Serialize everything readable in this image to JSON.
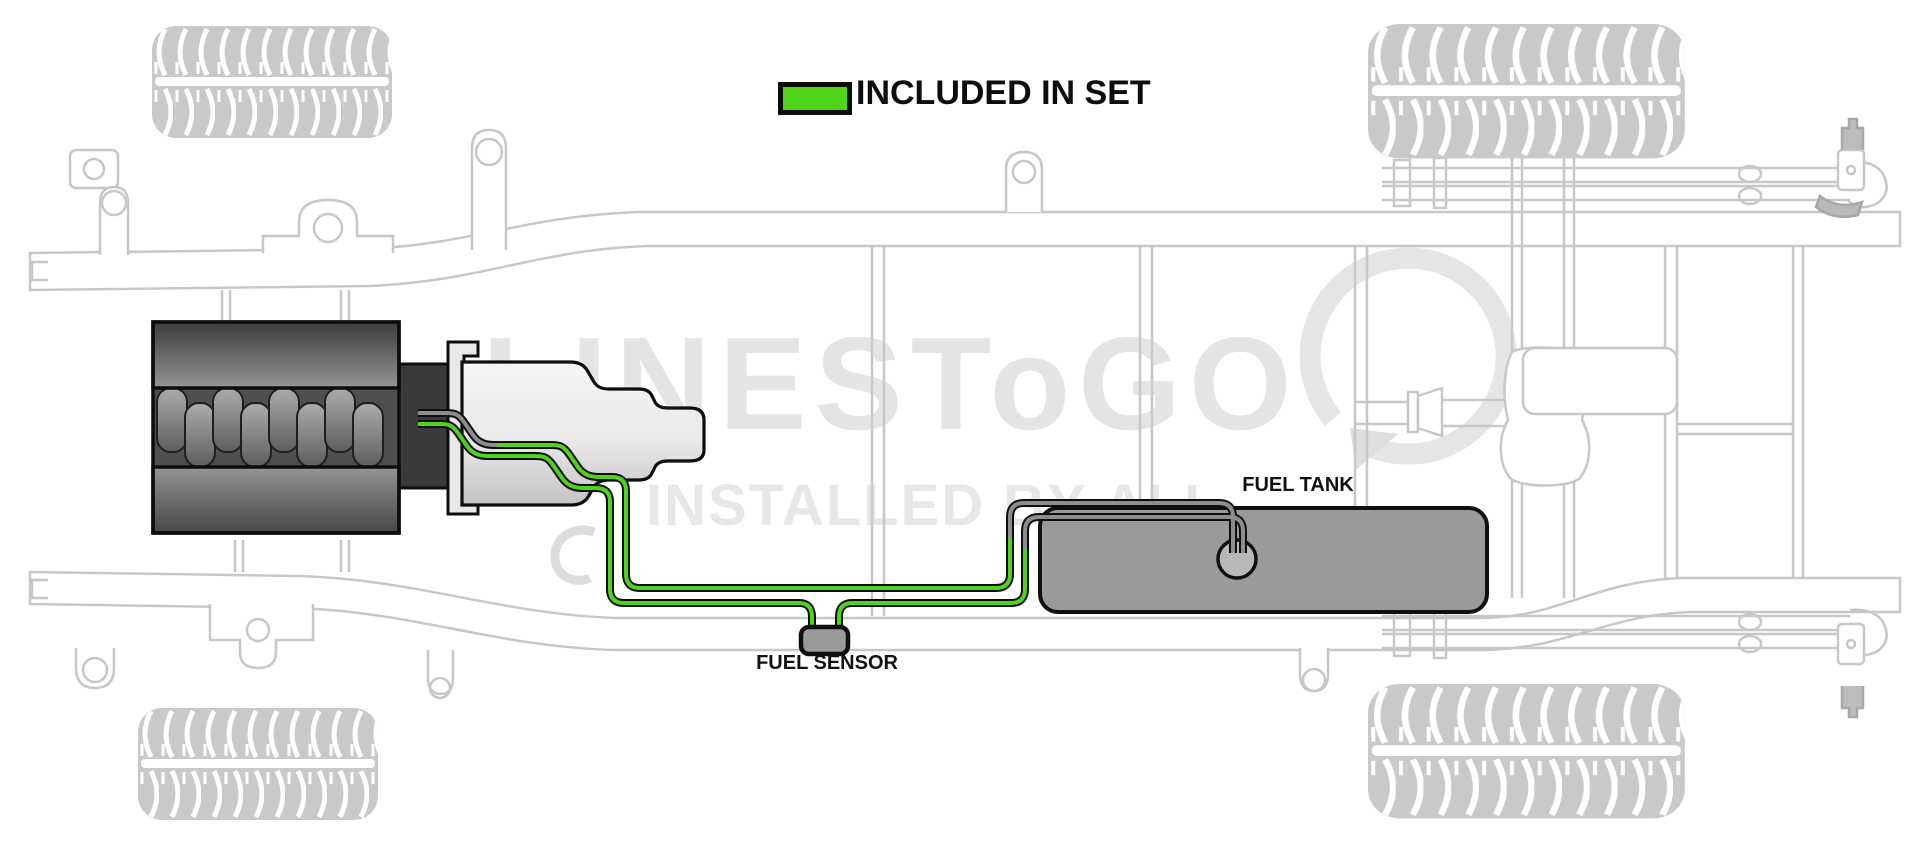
{
  "legend": {
    "label": "INCLUDED IN SET"
  },
  "callouts": {
    "fuel_tank": "FUEL TANK",
    "fuel_sensor": "FUEL SENSOR"
  },
  "watermark": {
    "brand": "LINESToGO",
    "tagline": "INSTALLED BY ALL"
  },
  "colors": {
    "included_green": "#4fd41a",
    "excluded_gray": "#8d8d8d",
    "line_outline": "#0e0e0e",
    "tank_gray": "#9a9a9a",
    "chassis_gray": "#c7c7c7",
    "watermark_gray": "#e4e4e4"
  }
}
